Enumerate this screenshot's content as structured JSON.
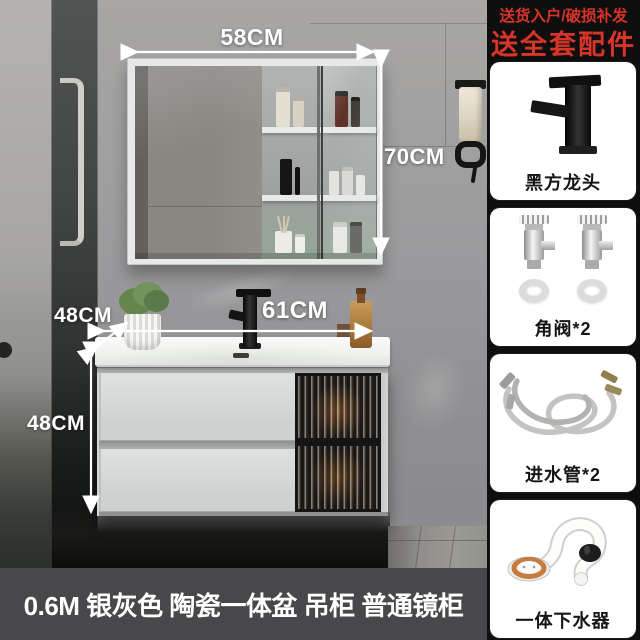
{
  "photo": {
    "dimensions": {
      "mirror_width": "58CM",
      "mirror_height": "70CM",
      "counter_depth": "48CM",
      "counter_width": "61CM",
      "cabinet_height": "48CM"
    },
    "caption": "0.6M 银灰色 陶瓷一体盆 吊柜 普通镜柜"
  },
  "sidebar": {
    "promo_line1": "送货入户/破损补发",
    "promo_line2": "送全套配件",
    "accent_color": "#d7342a",
    "cards": [
      {
        "label": "黑方龙头"
      },
      {
        "label": "角阀*2"
      },
      {
        "label": "进水管*2"
      },
      {
        "label": "一体下水器"
      }
    ]
  }
}
